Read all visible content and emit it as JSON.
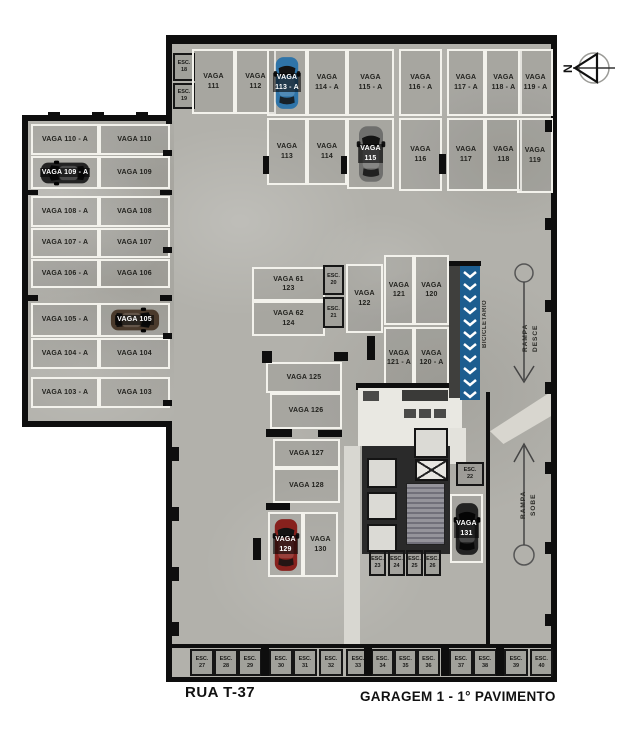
{
  "title": {
    "street": "RUA T-37",
    "caption": "GARAGEM 1 - 1° PAVIMENTO"
  },
  "compass": {
    "label": "N"
  },
  "areas": {
    "bike": "BICICLETARIO",
    "ramp_down": "RAMPA\nDESCE",
    "ramp_up": "RAMPA\nSOBE"
  },
  "colors": {
    "car_blue": "#2f74a8",
    "car_gray": "#6f6f6d",
    "car_black": "#232323",
    "car_brown": "#4a3a2c",
    "car_red": "#87211d",
    "bike_blue": "#1c5d8f"
  },
  "stalls": {
    "v111": "VAGA\n111",
    "v112": "VAGA\n112",
    "v113a": "VAGA\n113 - A",
    "v114a": "VAGA\n114 - A",
    "v115a": "VAGA\n115 - A",
    "v116a": "VAGA\n116 - A",
    "v117a": "VAGA\n117 - A",
    "v118a": "VAGA\n118 - A",
    "v119a": "VAGA\n119 - A",
    "v113": "VAGA\n113",
    "v114": "VAGA\n114",
    "v115": "VAGA\n115",
    "v116": "VAGA\n116",
    "v117": "VAGA\n117",
    "v118": "VAGA\n118",
    "v119": "VAGA\n119",
    "v110a": "VAGA 110 - A",
    "v110": "VAGA 110",
    "v109a": "VAGA 109 - A",
    "v109": "VAGA 109",
    "v108a": "VAGA 108 - A",
    "v108": "VAGA 108",
    "v107a": "VAGA 107 - A",
    "v107": "VAGA 107",
    "v106a": "VAGA 106 - A",
    "v106": "VAGA 106",
    "v105a": "VAGA 105 - A",
    "v105": "VAGA 105",
    "v104a": "VAGA 104 - A",
    "v104": "VAGA 104",
    "v103a": "VAGA 103 - A",
    "v103": "VAGA 103",
    "v61": "VAGA 61\n123",
    "v62": "VAGA 62\n124",
    "v122": "VAGA\n122",
    "v121": "VAGA\n121",
    "v120": "VAGA\n120",
    "v121a": "VAGA\n121 - A",
    "v120a": "VAGA\n120 - A",
    "v125": "VAGA 125",
    "v126": "VAGA 126",
    "v127": "VAGA 127",
    "v128": "VAGA 128",
    "v129": "VAGA\n129",
    "v130": "VAGA\n130",
    "v131": "VAGA\n131"
  },
  "esc": {
    "e18": "ESC.\n18",
    "e19": "ESC.\n19",
    "e20": "ESC.\n20",
    "e21": "ESC.\n21",
    "e22": "ESC.\n22",
    "e23": "ESC.\n23",
    "e24": "ESC.\n24",
    "e25": "ESC.\n25",
    "e26": "ESC.\n26",
    "e27": "ESC.\n27",
    "e28": "ESC.\n28",
    "e29": "ESC.\n29",
    "e30": "ESC.\n30",
    "e31": "ESC.\n31",
    "e32": "ESC.\n32",
    "e33": "ESC.\n33",
    "e34": "ESC.\n34",
    "e35": "ESC.\n35",
    "e36": "ESC.\n36",
    "e37": "ESC.\n37",
    "e38": "ESC.\n38",
    "e39": "ESC.\n39",
    "e40": "ESC.\n40"
  }
}
